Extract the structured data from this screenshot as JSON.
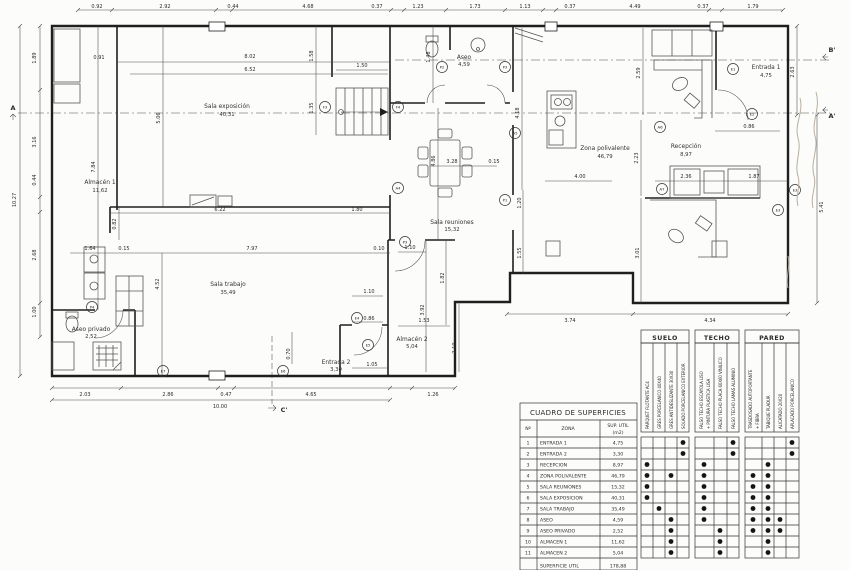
{
  "drawing": {
    "rooms": [
      {
        "name": "Sala exposición",
        "area": "40,31"
      },
      {
        "name": "Almacén 1",
        "area": "11,62"
      },
      {
        "name": "Sala trabajo",
        "area": "35,49"
      },
      {
        "name": "Aseo privado",
        "area": "2,52"
      },
      {
        "name": "Entrada 2",
        "area": "3,30"
      },
      {
        "name": "Almacén 2",
        "area": "5,04"
      },
      {
        "name": "Sala reuniones",
        "area": "15,32"
      },
      {
        "name": "Aseo",
        "area": "4,59"
      },
      {
        "name": "Zona polivalente",
        "area": "46,79"
      },
      {
        "name": "Recepción",
        "area": "8,97"
      },
      {
        "name": "Entrada 1",
        "area": "4,75"
      }
    ],
    "dims": [
      "0.92",
      "2.92",
      "0.44",
      "4.68",
      "0.37",
      "1.23",
      "1.73",
      "1.13",
      "0.37",
      "4.49",
      "0.37",
      "1.79",
      "1.89",
      "3.16",
      "0.44",
      "2.68",
      "1.00",
      "10.27",
      "2.63",
      "5.41",
      "2.03",
      "2.86",
      "0.47",
      "4.65",
      "1.26",
      "10.00",
      "3.74",
      "4.34",
      "0.91",
      "8.02",
      "6.52",
      "1.50",
      "1.58",
      "1.35",
      "1.48",
      "5.06",
      "7.84",
      "4.18",
      "2.59",
      "6.22",
      "1.80",
      "0.82",
      "1.64",
      "0.15",
      "7.97",
      "0.10",
      "4.52",
      "1.10",
      "4.86",
      "3.28",
      "0.15",
      "1.20",
      "1.55",
      "1.82",
      "4.00",
      "2.23",
      "2.36",
      "1.87",
      "3.01",
      "0.86",
      "1.10",
      "0.86",
      "1.53",
      "3.92",
      "2.10",
      "0.70",
      "1.05"
    ],
    "markers": [
      "P2",
      "P3",
      "F4",
      "F3",
      "A4",
      "A5",
      "A6",
      "A7",
      "P1",
      "E1",
      "E2",
      "E3",
      "E3",
      "E4",
      "E5",
      "E6",
      "E7",
      "P4",
      "P3"
    ],
    "sections": {
      "a": "A",
      "a2": "A'",
      "b2": "B'",
      "c2": "C'"
    }
  },
  "table": {
    "title": "CUADRO DE SUPERFICIES",
    "header": {
      "n": "Nº",
      "zona": "ZONA",
      "sup1": "SUP. UTIL",
      "sup2": "(m2)"
    },
    "groups": [
      {
        "name": "SUELO",
        "cols": [
          [
            "PARQUET FLOTANTE AC4"
          ],
          [
            "GRES PORCELANICO 40X40"
          ],
          [
            "GRES ANTIDESLIZANTE 30X30"
          ],
          [
            "SOLADO PORCELANICO EXTERIOR"
          ]
        ]
      },
      {
        "name": "TECHO",
        "cols": [
          [
            "FALSO TECHO ESCAYOLA LISO",
            "+ PINTURA PLASTICA LISA"
          ],
          [
            "FALSO TECHO PLACA 60X60 VINILICO"
          ],
          [
            "FALSO TECHO LAMAS ALUMINIO"
          ]
        ]
      },
      {
        "name": "PARED",
        "cols": [
          [
            "TRASDOSADO AUTOPORTANTE",
            "+ FIBRA"
          ],
          [
            "TABIQUE PLADUR"
          ],
          [
            "ALICATADO 20X20"
          ],
          [
            "APLACADO PORCELANICO"
          ]
        ]
      }
    ],
    "rows": [
      {
        "n": "1",
        "zona": "ENTRADA 1",
        "sup": "4,75",
        "materials": [
          "S4",
          "T3",
          "P4"
        ]
      },
      {
        "n": "2",
        "zona": "ENTRADA 2",
        "sup": "3,30",
        "materials": [
          "S4",
          "T3",
          "P4"
        ]
      },
      {
        "n": "3",
        "zona": "RECEPCION",
        "sup": "8,97",
        "materials": [
          "S1",
          "T1",
          "P2"
        ]
      },
      {
        "n": "4",
        "zona": "ZONA POLIVALENTE",
        "sup": "46,79",
        "materials": [
          "S1",
          "S3",
          "T1",
          "P1",
          "P2"
        ]
      },
      {
        "n": "5",
        "zona": "SALA REUNIONES",
        "sup": "15,32",
        "materials": [
          "S1",
          "T1",
          "P1",
          "P2"
        ]
      },
      {
        "n": "6",
        "zona": "SALA EXPOSICION",
        "sup": "40,31",
        "materials": [
          "S1",
          "T1",
          "P1",
          "P2"
        ]
      },
      {
        "n": "7",
        "zona": "SALA TRABAJO",
        "sup": "35,49",
        "materials": [
          "S2",
          "T1",
          "P1",
          "P2"
        ]
      },
      {
        "n": "8",
        "zona": "ASEO",
        "sup": "4,59",
        "materials": [
          "S3",
          "T1",
          "P1",
          "P2",
          "P3"
        ]
      },
      {
        "n": "9",
        "zona": "ASEO PRIVADO",
        "sup": "2,52",
        "materials": [
          "S3",
          "T2",
          "P1",
          "P2",
          "P3"
        ]
      },
      {
        "n": "10",
        "zona": "ALMACEN 1",
        "sup": "11,62",
        "materials": [
          "S3",
          "T2",
          "P2"
        ]
      },
      {
        "n": "11",
        "zona": "ALMACEN 2",
        "sup": "5,04",
        "materials": [
          "S3",
          "T2",
          "P2"
        ]
      }
    ],
    "total_label": "SUPERFICIE UTIL",
    "total_value": "178,88"
  }
}
